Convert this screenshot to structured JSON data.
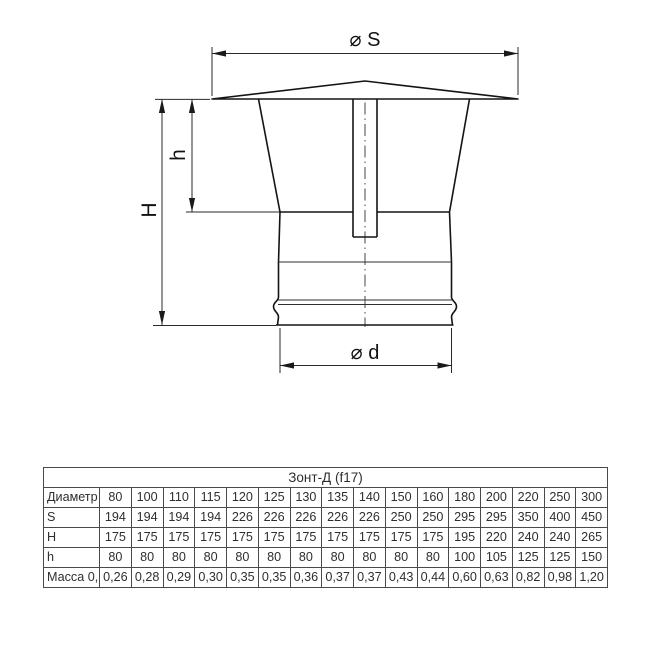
{
  "drawing": {
    "dim_top_label": "⌀ S",
    "dim_height_label": "H",
    "dim_inner_height_label": "h",
    "dim_bottom_label": "⌀ d"
  },
  "table": {
    "title": "Зонт-Д (f17)",
    "rows": [
      {
        "label": "Диаметр",
        "values": [
          "80",
          "100",
          "110",
          "115",
          "120",
          "125",
          "130",
          "135",
          "140",
          "150",
          "160",
          "180",
          "200",
          "220",
          "250",
          "300"
        ]
      },
      {
        "label": "S",
        "values": [
          "194",
          "194",
          "194",
          "194",
          "226",
          "226",
          "226",
          "226",
          "226",
          "250",
          "250",
          "295",
          "295",
          "350",
          "400",
          "450"
        ]
      },
      {
        "label": "H",
        "values": [
          "175",
          "175",
          "175",
          "175",
          "175",
          "175",
          "175",
          "175",
          "175",
          "175",
          "175",
          "195",
          "220",
          "240",
          "240",
          "265"
        ]
      },
      {
        "label": "h",
        "values": [
          "80",
          "80",
          "80",
          "80",
          "80",
          "80",
          "80",
          "80",
          "80",
          "80",
          "80",
          "100",
          "105",
          "125",
          "125",
          "150"
        ]
      },
      {
        "label": "Масса 0,5",
        "values": [
          "0,26",
          "0,28",
          "0,29",
          "0,30",
          "0,35",
          "0,35",
          "0,36",
          "0,37",
          "0,37",
          "0,43",
          "0,44",
          "0,60",
          "0,63",
          "0,82",
          "0,98",
          "1,20"
        ]
      }
    ]
  }
}
